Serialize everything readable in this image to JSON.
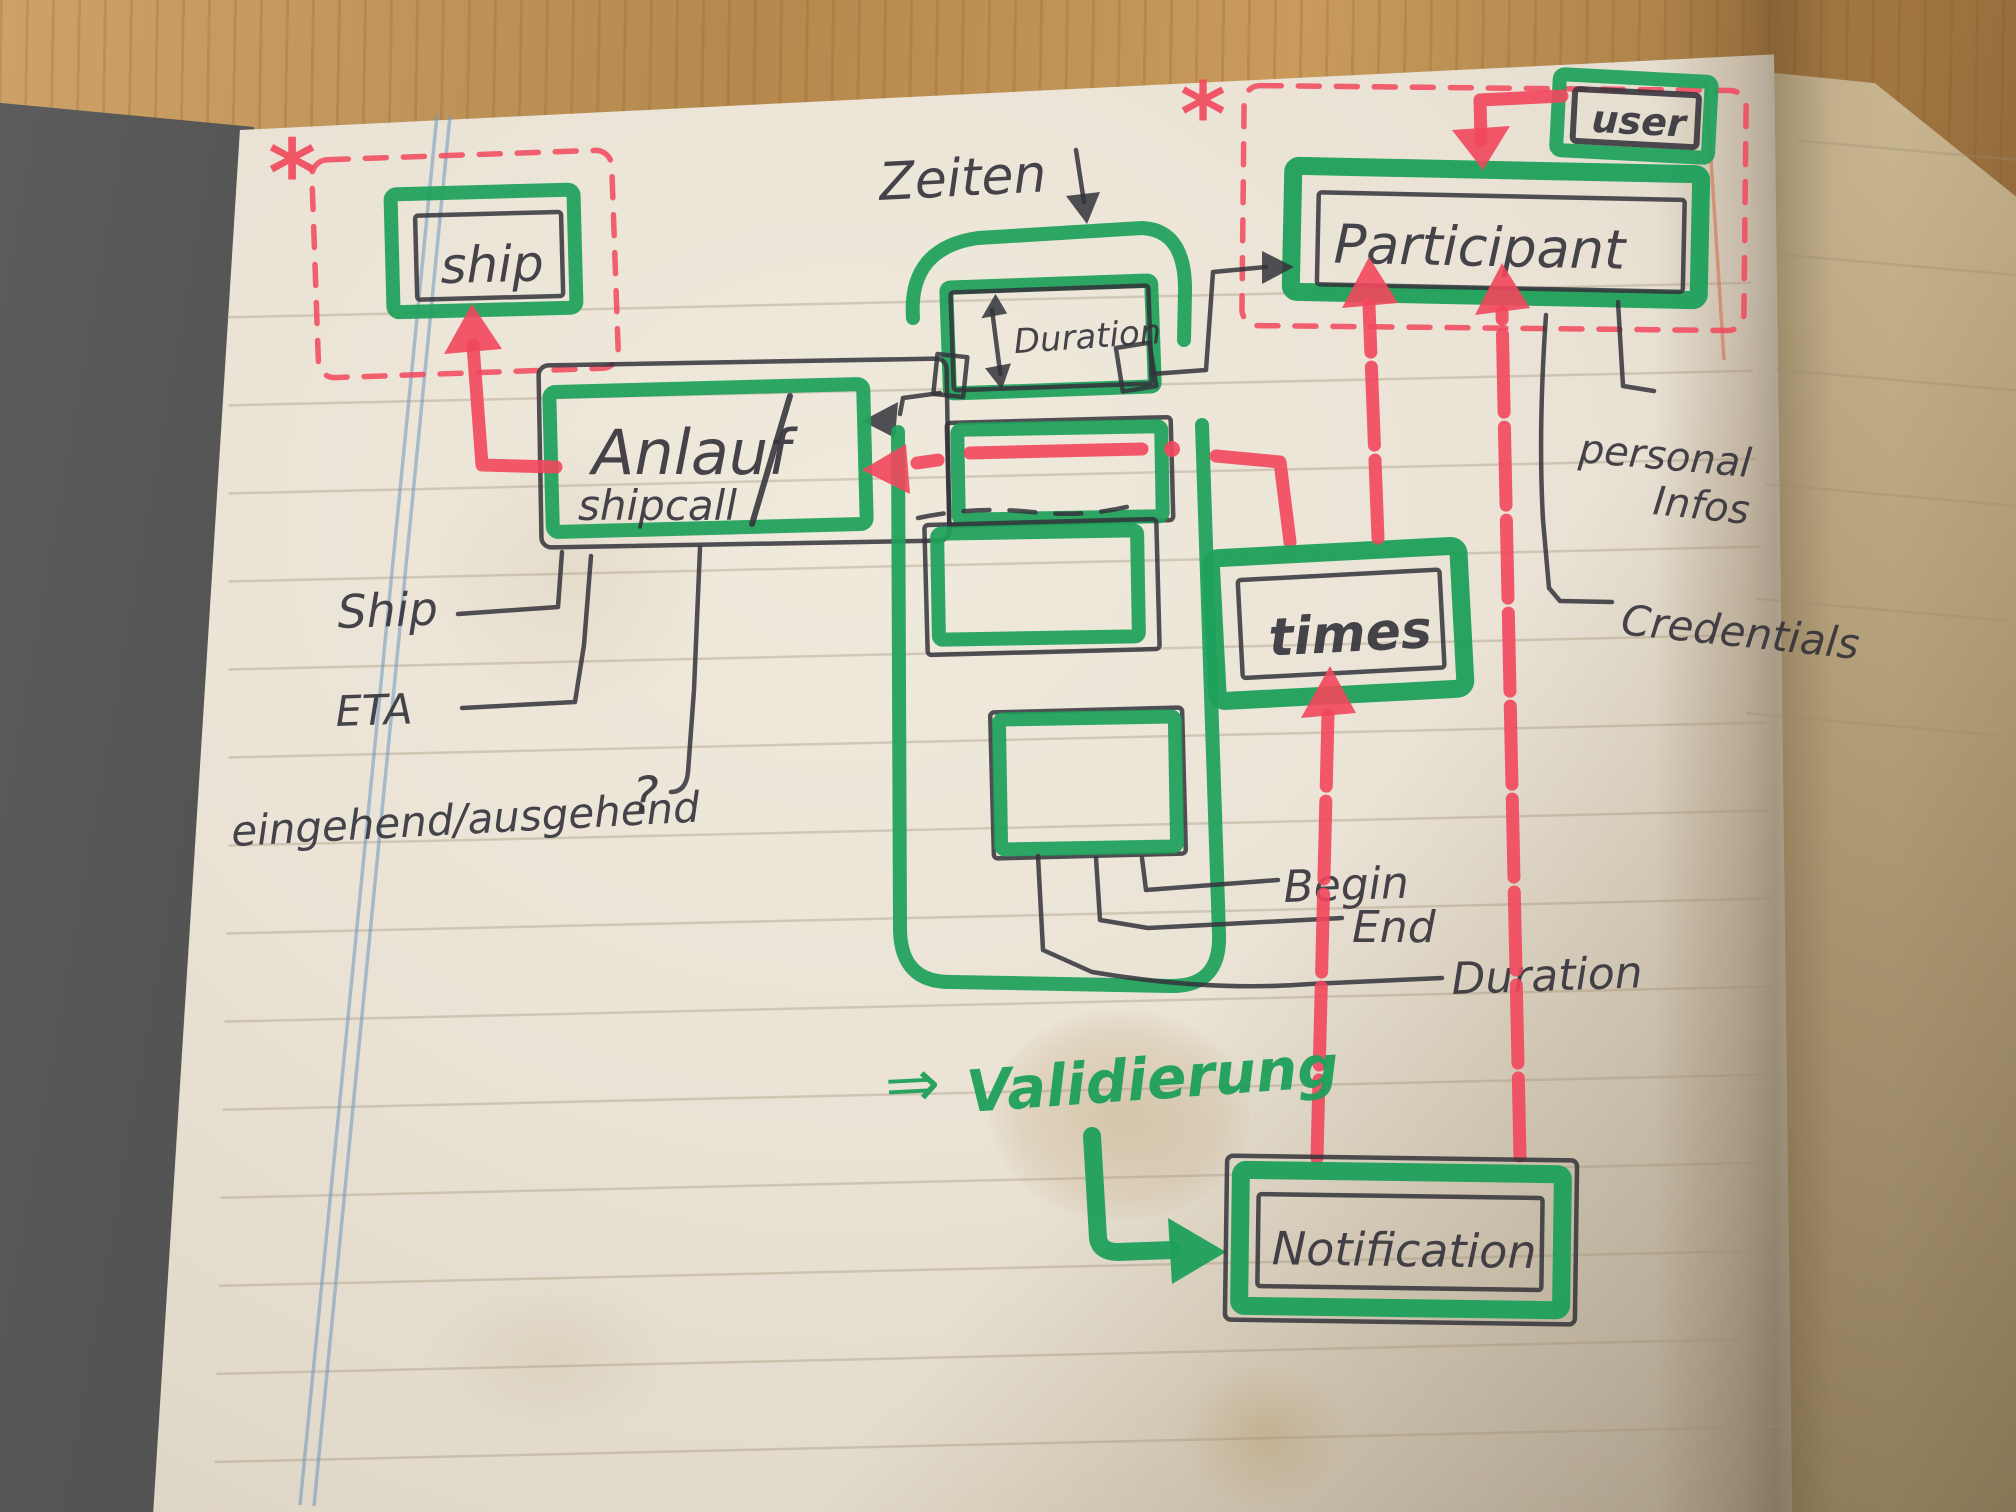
{
  "boxes": {
    "ship": {
      "label": "ship"
    },
    "anlauf": {
      "line1": "Anlauf",
      "line2": "shipcall"
    },
    "duration": {
      "label": "Duration"
    },
    "participant": {
      "label": "Participant"
    },
    "user": {
      "label": "user"
    },
    "times": {
      "label": "times"
    },
    "notification": {
      "label": "Notification"
    }
  },
  "labels": {
    "zeiten": "Zeiten",
    "zeiten_arrow": "↓",
    "ship_attr": "Ship",
    "eta": "ETA",
    "in_out": "eingehend/ausgehend",
    "question_mark": "?",
    "begin": "Begin",
    "end": "End",
    "duration_attr": "Duration",
    "validierung_arrow": "⇒",
    "validierung": "Validierung",
    "personal_line1": "personal",
    "personal_line2": "Infos",
    "credentials": "Credentials",
    "asterisk_left": "*",
    "asterisk_right": "*"
  },
  "colors": {
    "marker_green": "#1ea05a",
    "marker_red": "#f2475c",
    "ink": "#33323a",
    "rule": "#9c8a6d",
    "margin_blue": "#6d97c0",
    "paper": "#e9e2d5",
    "paper_right": "#d9c9a9",
    "wood": "#b5884d",
    "cover": "#454545"
  }
}
